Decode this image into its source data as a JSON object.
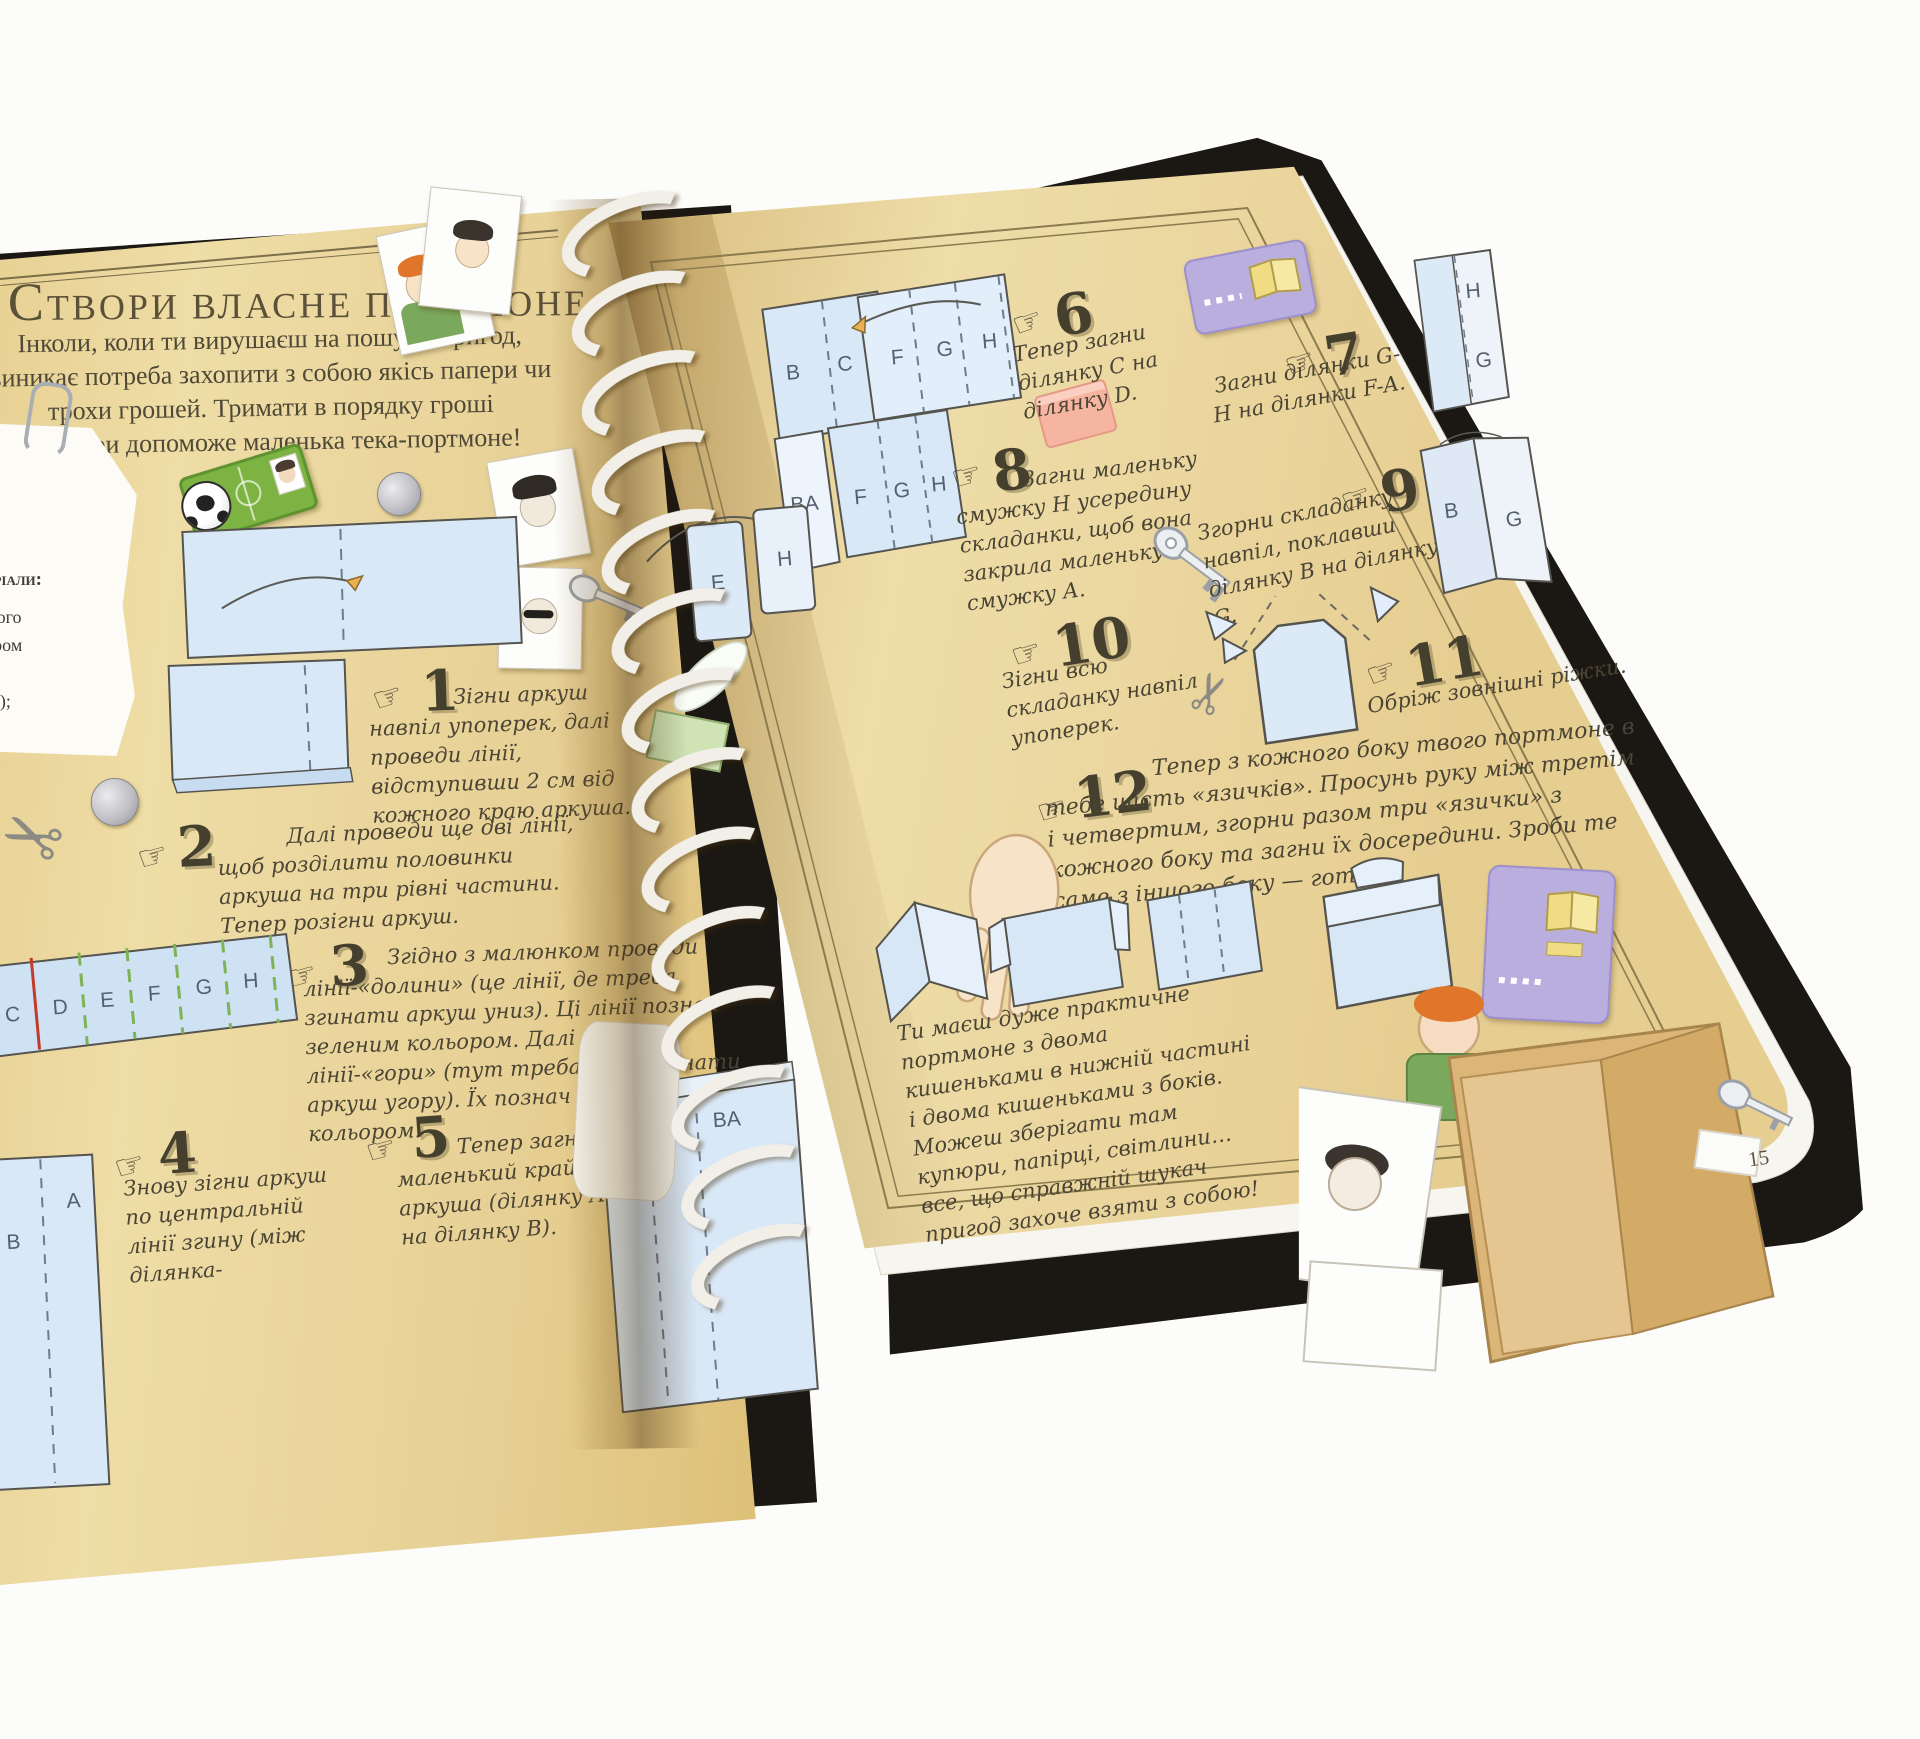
{
  "book": {
    "title": "Створи власне портмоне",
    "intro_lines": [
      "Інколи, коли ти вирушаєш на пошуки пригод,",
      "виникає потреба захопити з собою якісь папери чи",
      "трохи грошей. Тримати в порядку гроші",
      "й папери допоможе маленька тека-портмоне!"
    ],
    "materials": {
      "heading": "Матеріали:",
      "lines": [
        "товстого",
        "розміром",
        "(чи 1",
        "постер);"
      ]
    },
    "steps": [
      {
        "num": "1",
        "text": "Зігни аркуш навпіл упоперек, далі проведи лінії, відступивши 2 см від кожного краю аркуша."
      },
      {
        "num": "2",
        "text": "Далі проведи ще дві лінії, щоб розділити половинки аркуша на три рівні частини. Тепер розігни аркуш."
      },
      {
        "num": "3",
        "text": "Згідно з малюнком проведи лінії-«долини» (це лінії, де треба згинати аркуш униз). Ці лінії познач зеленим кольором. Далі проведи лінії-«гори» (тут треба буде згинати аркуш угору). Їх познач червоним кольором."
      },
      {
        "num": "4",
        "text": "Знову зігни аркуш по центральній лінії згину (між ділянка-"
      },
      {
        "num": "5",
        "text": "Тепер загни маленький крайчок аркуша (ділянку А на ділянку В)."
      },
      {
        "num": "6",
        "text": "Тепер загни ділянку С на ділянку D."
      },
      {
        "num": "7",
        "text": "Загни ділянки G-H на ділянки F-A."
      },
      {
        "num": "8",
        "text": "Загни маленьку смужку H усередину складанки, щоб вона закрила маленьку смужку А."
      },
      {
        "num": "9",
        "text": "Згорни складанку навпіл, поклавши ділянку В на ділянку G."
      },
      {
        "num": "10",
        "text": "Зігни всю складанку навпіл упоперек."
      },
      {
        "num": "11",
        "text": "Обріж зовнішні ріжки."
      },
      {
        "num": "12",
        "text": "Тепер з кожного боку твого портмоне в тебе шість «язичків». Просунь руку між третім і четвертим, згорни разом три «язички» з кожного боку та загни їх досередини. Зроби те саме з іншого боку — готово!"
      }
    ],
    "outro": "Ти маєш дуже практичне портмоне з двома кишеньками в нижній частині і двома кишеньками з боків. Можеш зберігати там купюри, папірці, світлини… все, що справжній шукач пригод захоче взяти з собою!",
    "page_number": "15",
    "diagrams": {
      "strip": [
        "C",
        "D",
        "E",
        "F",
        "G",
        "H"
      ],
      "s4": [
        "B",
        "A"
      ],
      "s5": [
        "D",
        "C",
        "BA"
      ],
      "s6": [
        "B",
        "C",
        "F",
        "G",
        "H"
      ],
      "s8": [
        "BA",
        "F",
        "G",
        "H"
      ],
      "corner": [
        "H",
        "G"
      ],
      "s9": [
        "B",
        "G"
      ],
      "s10": [
        "E",
        "H"
      ]
    },
    "icons": {
      "hand": "☞",
      "scissors": "✂"
    },
    "colors": {
      "page": "#e8d198",
      "cover": "#1b1712",
      "paper_blue": "#d9e8f7",
      "valley_green": "#7cb454",
      "mountain_red": "#c23b2a",
      "sticker_green": "#7cb342",
      "purple_card": "#b9aedd"
    }
  }
}
